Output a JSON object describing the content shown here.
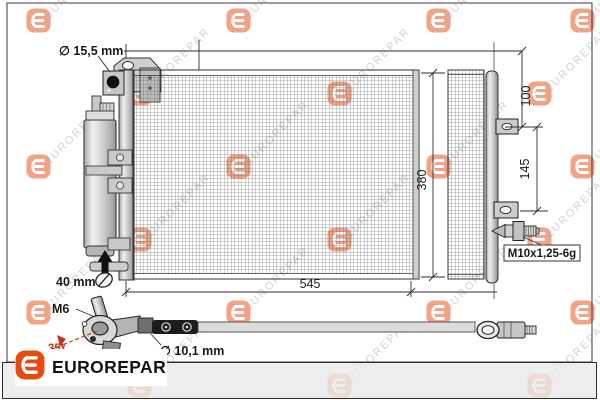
{
  "watermark": {
    "text": "EUROREPAR",
    "text_color": "#b5b5b5",
    "icon_color": "#e8490d"
  },
  "diagram": {
    "labels": {
      "port_diameter": "∅ 15,5 mm",
      "bracket_offset_top": "100",
      "bracket_spacing": "145",
      "height_total": "380",
      "width_total": "545",
      "drier_dimension": "40 mm",
      "valve_thread": "M6",
      "valve_angle": "35°",
      "hose_diameter": "∅ 10,1 mm",
      "fitting_thread": "M10x1,25-6g"
    },
    "angle_color": "#c62f1e",
    "line_color": "#2d2d2d"
  },
  "footer": {
    "brand": "EUROREPAR",
    "logo_color": "#e8490d"
  }
}
